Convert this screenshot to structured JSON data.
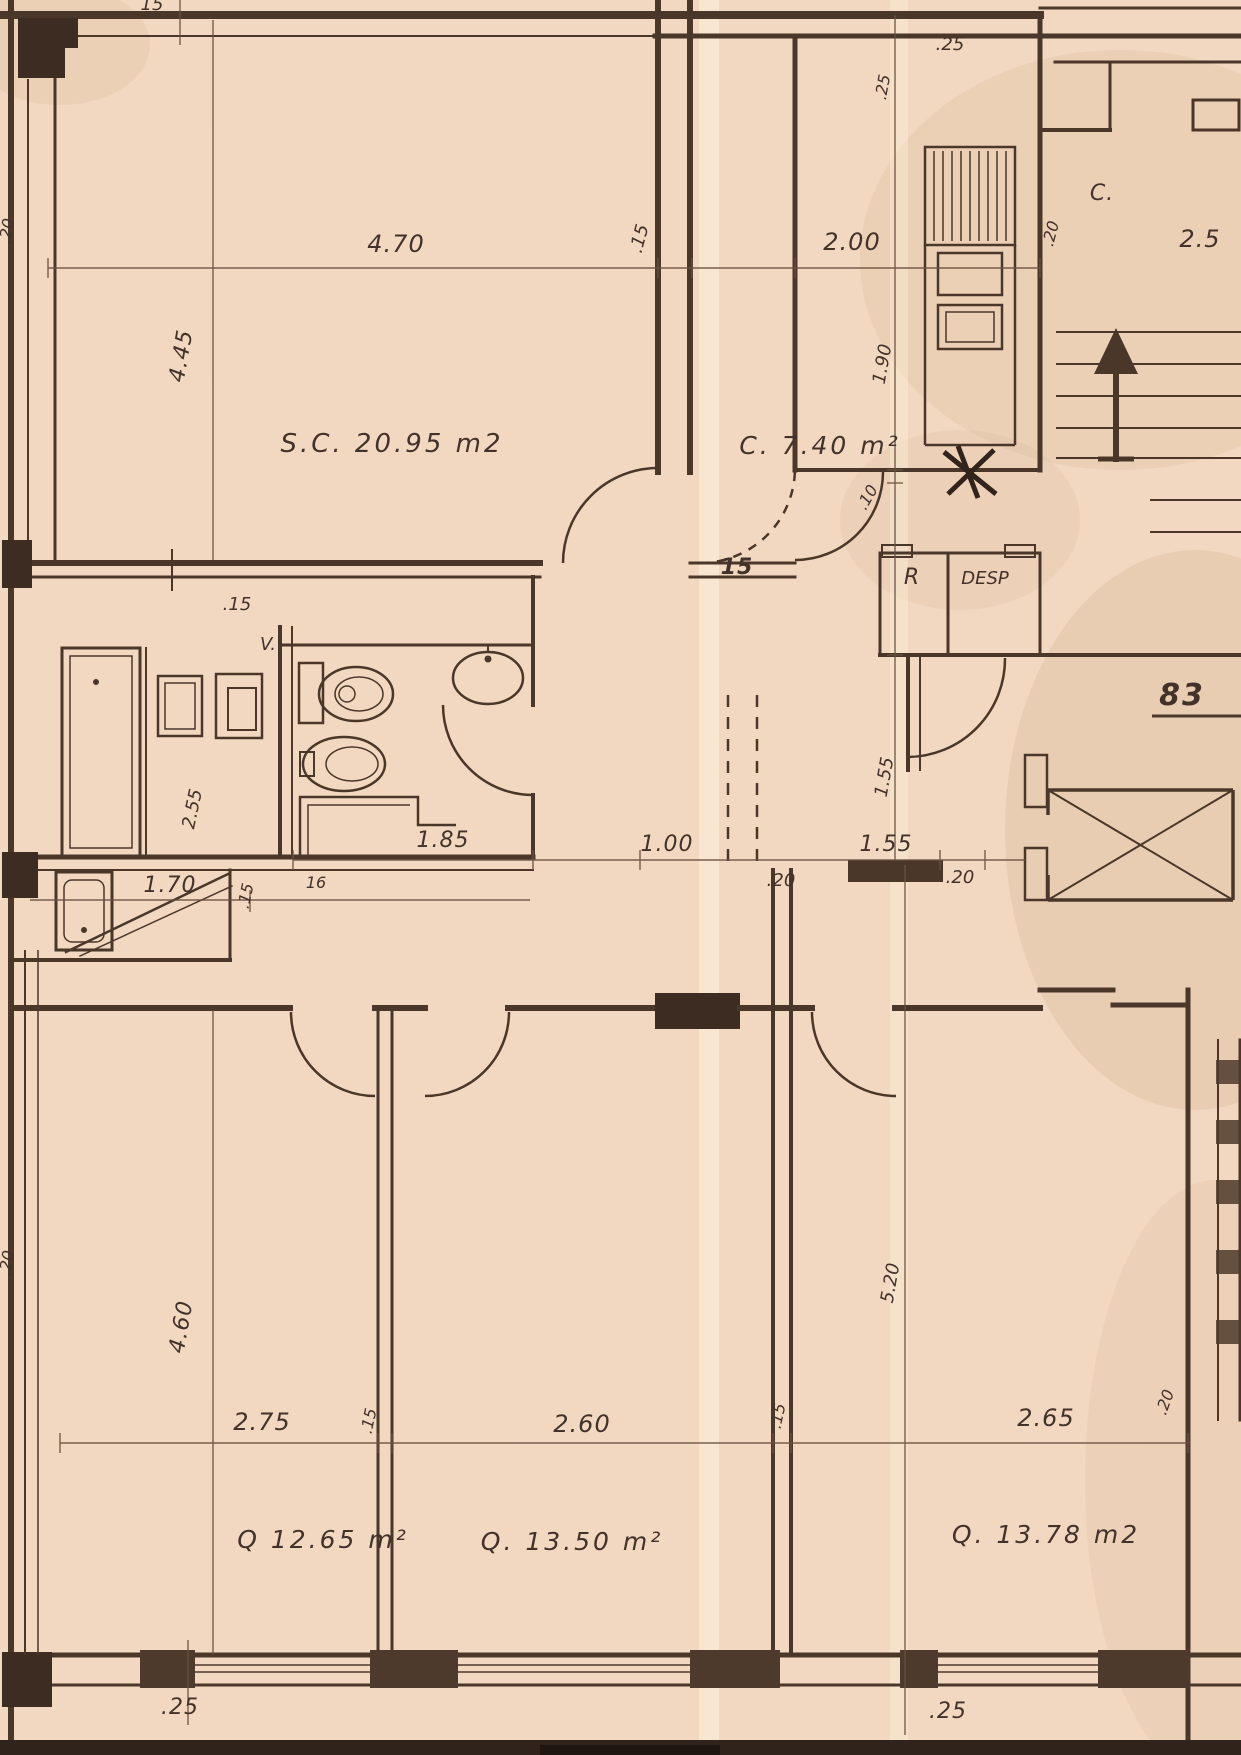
{
  "meta": {
    "type": "scanned architectural floor plan",
    "paper_color": "#f2d8c0",
    "ink_color": "#4a372a"
  },
  "plan": {
    "rooms": {
      "living": "S.C. 20.95 m2",
      "kitchen": "C. 7.40 m²",
      "pantry_r": "R",
      "pantry_desp": "DESP",
      "closet": "C.",
      "vent": "V.",
      "bedroom1": "Q 12.65 m²",
      "bedroom2": "Q. 13.50 m²",
      "bedroom3": "Q. 13.78 m2",
      "stair_mark": "83"
    },
    "dims": {
      "top_tick_15": "15",
      "living_width": "4.70",
      "wall_thickness_15": ".15",
      "kitchen_width": "2.00",
      "kitchen_wall_25": ".25",
      "shaft_25": ".25",
      "closet_wall_20": ".20",
      "entry_width": "2.5",
      "living_height": "4.45",
      "kitchen_depth": "1.90",
      "wall_10": ".10",
      "hall_wall_15": "15",
      "bath_wall_15": ".15",
      "bath_depth": "2.55",
      "bath_width": "1.85",
      "nook_width": "1.70",
      "nook_wall_15": ".15",
      "nook_16": "16",
      "hall_width": "1.00",
      "hall_wall_20_left": ".20",
      "corridor_width": "1.55",
      "hall_wall_20_right": ".20",
      "corridor_depth": "1.55",
      "left_edge_20_upper": ".20",
      "left_edge_20_lower": ".20",
      "bedroom1_depth": "4.60",
      "bedroom3_depth": "5.20",
      "bedroom1_width": "2.75",
      "divider_15_a": ".15",
      "bedroom2_width": "2.60",
      "divider_15_b": ".15",
      "bedroom3_width": "2.65",
      "right_wall_20": ".20",
      "sill_25_left": ".25",
      "sill_25_right": ".25"
    }
  }
}
